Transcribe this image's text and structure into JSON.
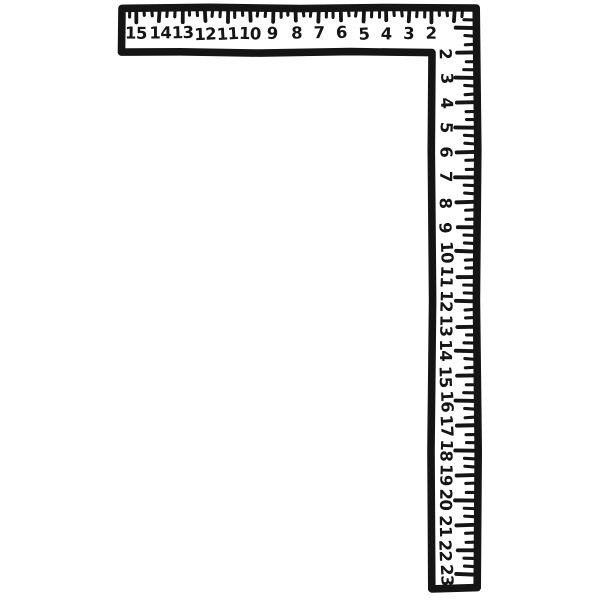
{
  "illustration": {
    "object": "carpenter-framing-square",
    "style": "hand-drawn line art",
    "background_color": "#ffffff",
    "ink_color": "#151515"
  },
  "blade_scale": {
    "position": "top-horizontal-arm",
    "tick_edge": "top",
    "reading_direction": "right-to-left from corner",
    "labels": [
      "15",
      "14",
      "13",
      "12",
      "11",
      "10",
      "9",
      "8",
      "7",
      "6",
      "5",
      "4",
      "3",
      "2"
    ]
  },
  "tongue_scale": {
    "position": "right-vertical-arm",
    "tick_edge": "right",
    "reading_direction": "top-to-bottom from corner, digits rotated 90deg clockwise",
    "labels": [
      "2",
      "3",
      "4",
      "5",
      "6",
      "7",
      "8",
      "9",
      "10",
      "11",
      "12",
      "13",
      "14",
      "15",
      "16",
      "17",
      "18",
      "19",
      "20",
      "21",
      "22",
      "23"
    ]
  }
}
